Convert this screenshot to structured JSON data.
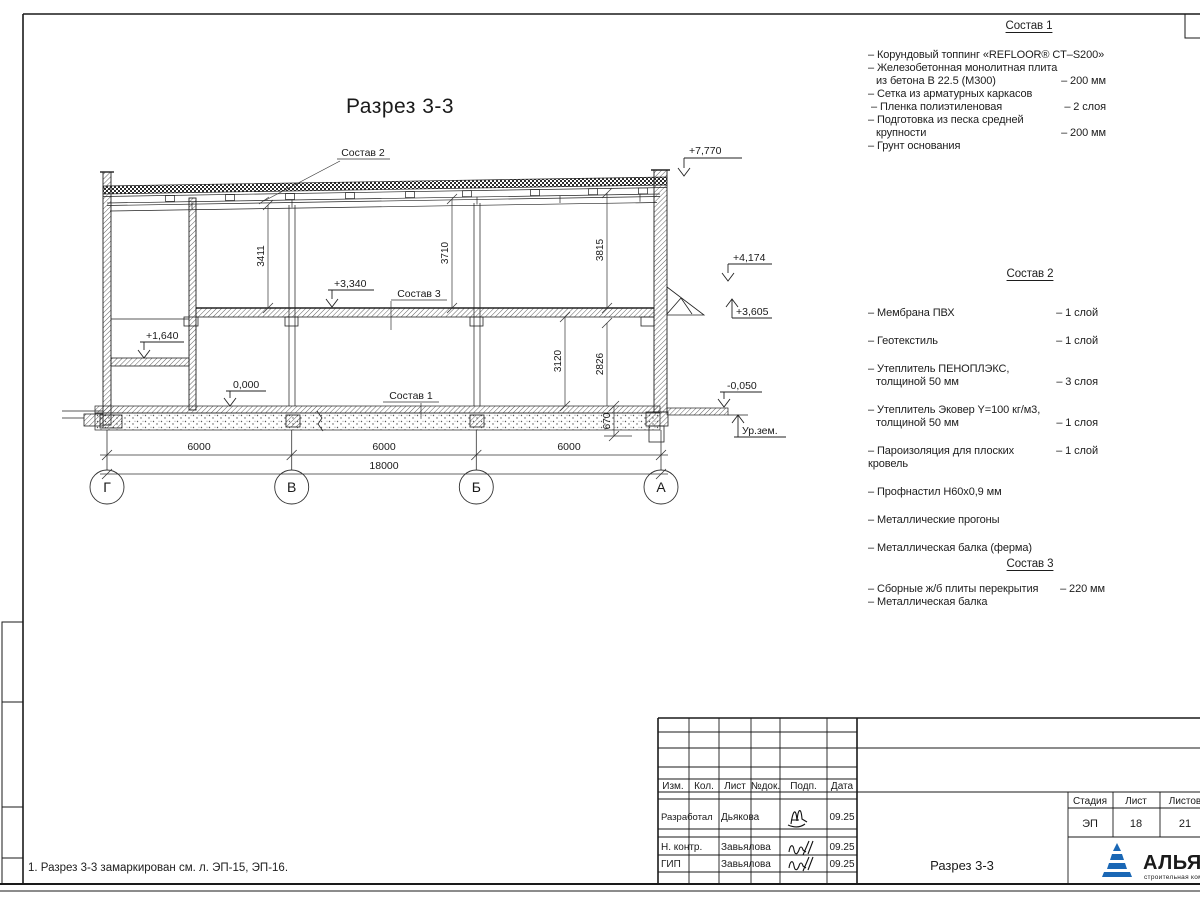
{
  "drawing": {
    "title": "Разрез 3-3",
    "labels": {
      "sostav1": "Состав 1",
      "sostav2": "Состав 2",
      "sostav3": "Состав 3"
    },
    "levels": {
      "l7770": "+7,770",
      "l4174": "+4,174",
      "l3605": "+3,605",
      "l3340": "+3,340",
      "l1640": "+1,640",
      "l0": "0,000",
      "lm050": "-0,050",
      "ground": "Ур.зем."
    },
    "dims": {
      "d3411": "3411",
      "d3710": "3710",
      "d3815": "3815",
      "d3120": "3120",
      "d2826": "2826",
      "d670": "670",
      "d6000": "6000",
      "d18000": "18000"
    },
    "axes": [
      "Г",
      "В",
      "Б",
      "А"
    ]
  },
  "lists": {
    "s1": {
      "title": "Состав 1",
      "lines": [
        {
          "t": "– Корундовый топпинг «REFLOOR® CT–S200»"
        },
        {
          "t": "– Железобетонная  монолитная плита"
        },
        {
          "t": "из бетона В 22.5 (М300)",
          "v": "– 200 мм"
        },
        {
          "t": "– Сетка из арматурных каркасов"
        },
        {
          "t": "– Пленка полиэтиленовая",
          "v": "– 2 слоя"
        },
        {
          "t": "– Подготовка из песка средней"
        },
        {
          "t": "крупности",
          "v": "– 200 мм"
        },
        {
          "t": "– Грунт основания"
        }
      ]
    },
    "s2": {
      "title": "Состав 2",
      "items": [
        {
          "lines": [
            {
              "t": "– Мембрана ПВХ",
              "v": "– 1 слой"
            }
          ]
        },
        {
          "lines": [
            {
              "t": "– Геотекстиль",
              "v": "– 1 слой"
            }
          ]
        },
        {
          "lines": [
            {
              "t": "– Утеплитель ПЕНОПЛЭКС,"
            },
            {
              "t": "толщиной 50 мм",
              "v": "– 3 слоя"
            }
          ]
        },
        {
          "lines": [
            {
              "t": "– Утеплитель Эковер Y=100 кг/м3,"
            },
            {
              "t": "толщиной 50 мм",
              "v": "– 1 слоя"
            }
          ]
        },
        {
          "lines": [
            {
              "t": "– Пароизоляция для плоских кровель",
              "v": "– 1 слой"
            }
          ]
        },
        {
          "lines": [
            {
              "t": "– Профнастил Н60х0,9 мм"
            }
          ]
        },
        {
          "lines": [
            {
              "t": "– Металлические прогоны"
            }
          ]
        },
        {
          "lines": [
            {
              "t": "– Металлическая балка (ферма)"
            }
          ]
        }
      ]
    },
    "s3": {
      "title": "Состав 3",
      "lines": [
        {
          "t": "– Сборные ж/б плиты перекрытия",
          "v": "– 220 мм"
        },
        {
          "t": "– Металлическая балка"
        }
      ]
    }
  },
  "note": "1. Разрез 3-3 замаркирован см. л. ЭП-15, ЭП-16.",
  "tb": {
    "cols": [
      "Изм.",
      "Кол.",
      "Лист",
      "№док.",
      "Подп.",
      "Дата"
    ],
    "rows": [
      {
        "role": "Разработал",
        "name": "Дьякова",
        "date": "09.25"
      },
      {
        "role": "Н. контр.",
        "name": "Завьялова",
        "date": "09.25"
      },
      {
        "role": "ГИП",
        "name": "Завьялова",
        "date": "09.25"
      }
    ],
    "stage_h": "Стадия",
    "list_h": "Лист",
    "listov_h": "Листов",
    "stage": "ЭП",
    "list": "18",
    "listov": "21",
    "name": "Разрез 3-3",
    "brand": "АЛЬЯНС",
    "brand_sub": "строительная компания",
    "brand_blue": "#1c3e86",
    "brand_red": "#d03232",
    "brand_tri": "#1a67b5"
  }
}
